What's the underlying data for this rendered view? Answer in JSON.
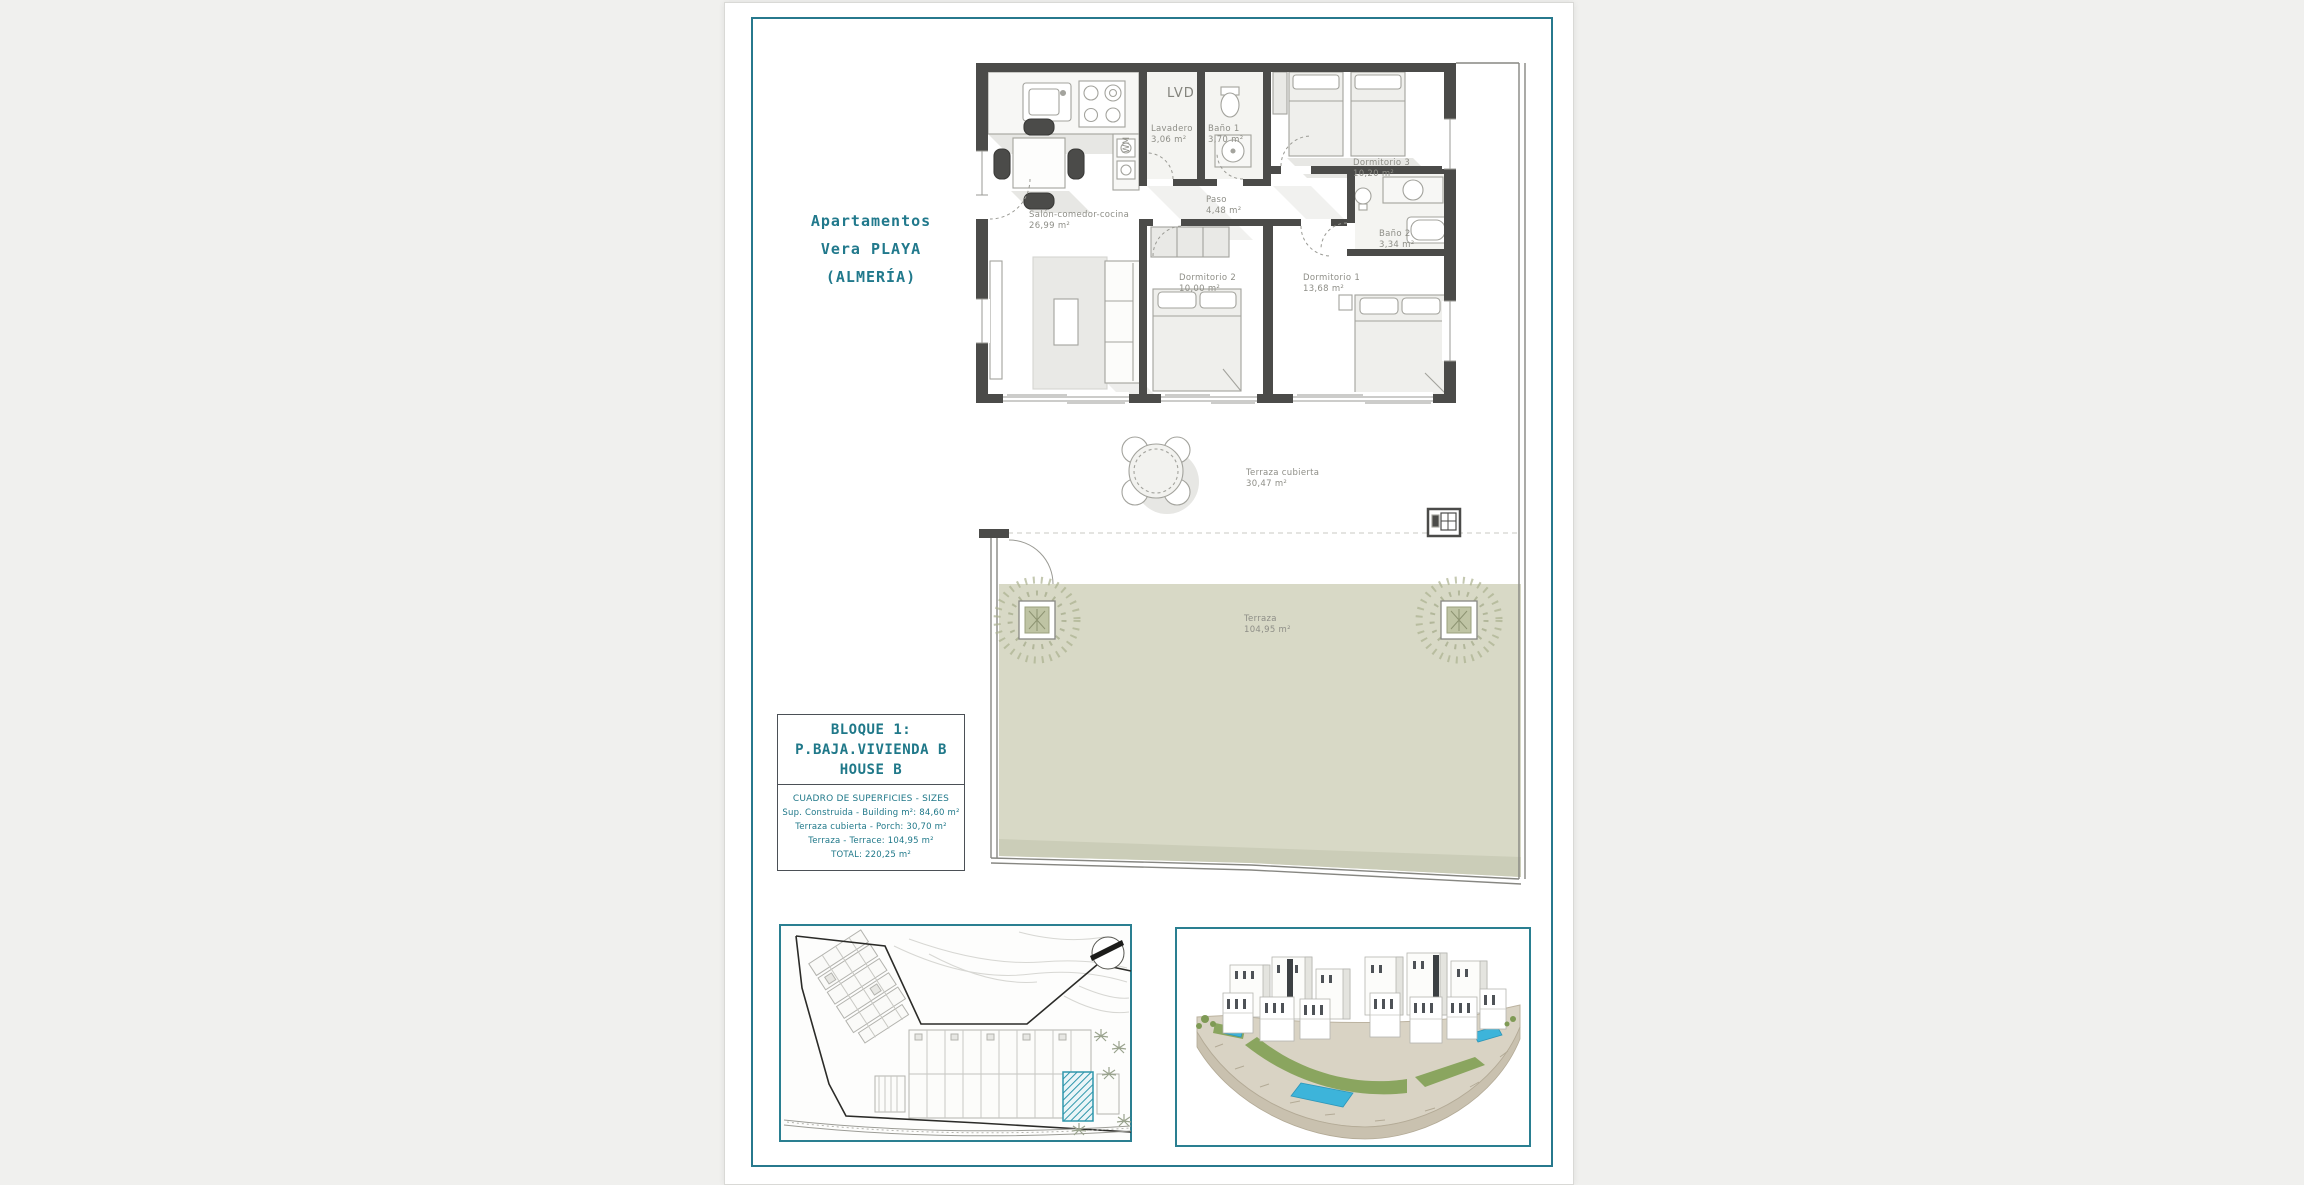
{
  "page": {
    "title_lines": [
      "Apartamentos",
      "Vera PLAYA",
      "(ALMERÍA)"
    ]
  },
  "plan": {
    "lvd_label": "LVD",
    "wm_label": "WM",
    "rooms": [
      {
        "name": "Salón-comedor-cocina",
        "area": "26,99 m²"
      },
      {
        "name": "Lavadero",
        "area": "3,06 m²"
      },
      {
        "name": "Baño 1",
        "area": "3,70 m²"
      },
      {
        "name": "Paso",
        "area": "4,48 m²"
      },
      {
        "name": "Dormitorio 3",
        "area": "10,20 m²"
      },
      {
        "name": "Dormitorio 2",
        "area": "10,00 m²"
      },
      {
        "name": "Dormitorio 1",
        "area": "13,68 m²"
      },
      {
        "name": "Baño 2",
        "area": "3,34 m²"
      },
      {
        "name": "Terraza cubierta",
        "area": "30,47 m²"
      },
      {
        "name": "Terraza",
        "area": "104,95 m²"
      }
    ]
  },
  "unit_info": {
    "block_lines": [
      "BLOQUE 1:",
      "P.BAJA.VIVIENDA B",
      "HOUSE B"
    ],
    "sizes_title": "CUADRO DE SUPERFICIES - SIZES",
    "sizes_lines": [
      "Sup. Construida - Building m²: 84,60 m²",
      "Terraza cubierta - Porch: 30,70 m²",
      "Terraza - Terrace: 104,95 m²",
      "TOTAL: 220,25 m²"
    ]
  },
  "colors": {
    "accent_teal": "#27798d",
    "terrace_green": "#d8d9c6",
    "highlight_hatch": "#2f97ac",
    "wall_dark": "#4b4b49"
  }
}
